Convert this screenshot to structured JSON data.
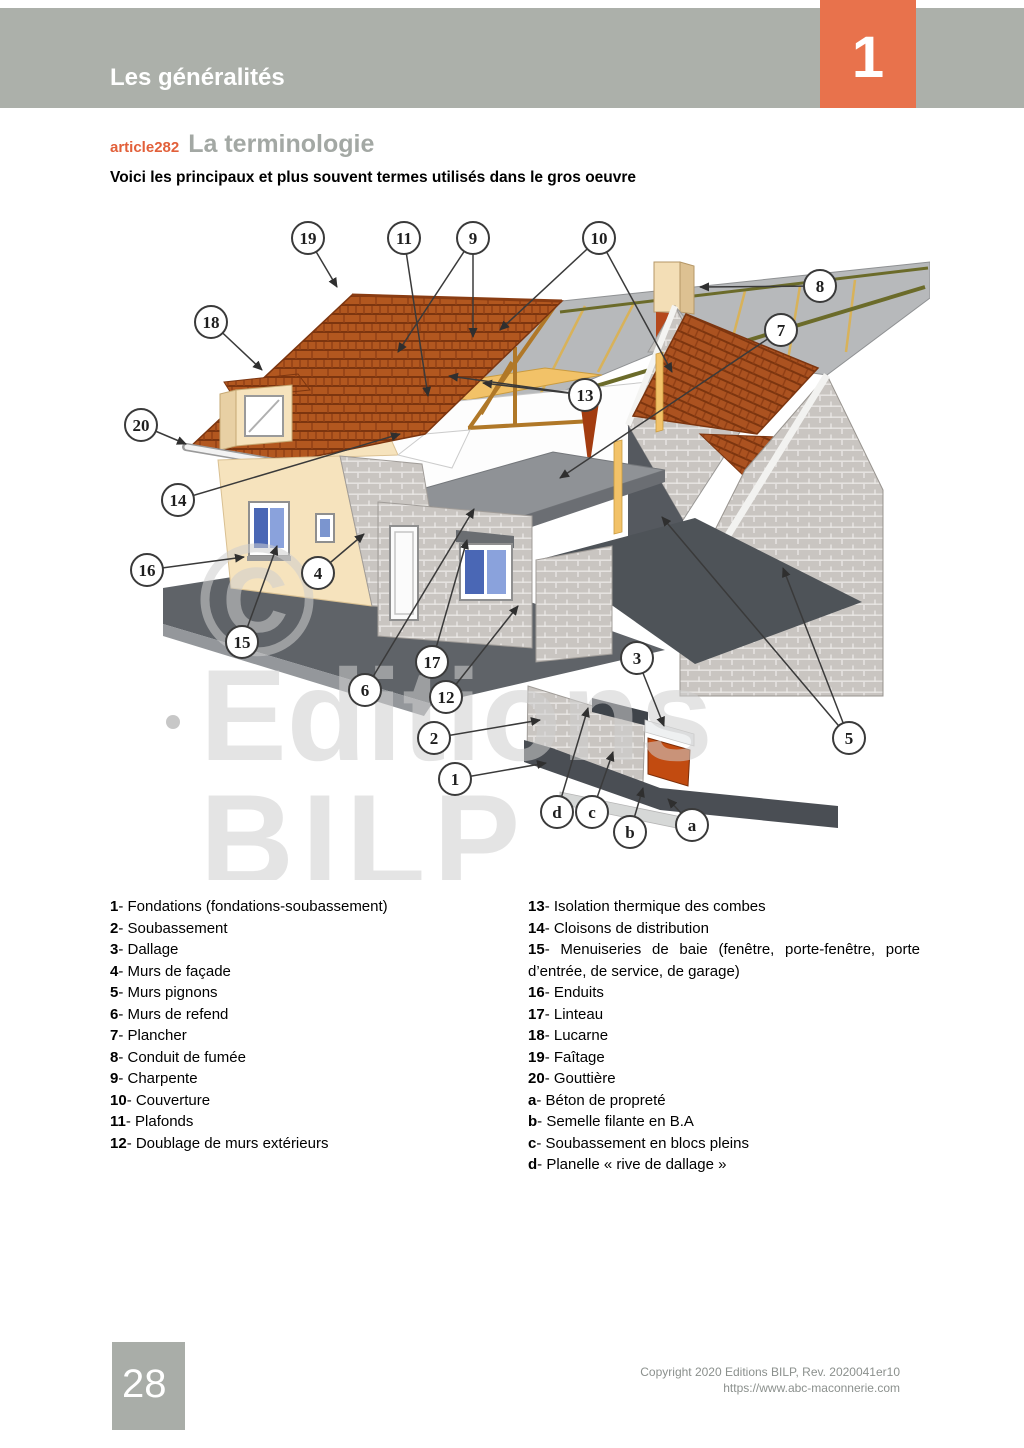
{
  "header": {
    "chapter_title": "Les généralités",
    "chapter_number": "1"
  },
  "article": {
    "id": "article282",
    "title": "La terminologie",
    "intro": "Voici les principaux et plus souvent termes utilisés dans le gros oeuvre"
  },
  "diagram": {
    "watermark": {
      "symbol": "©",
      "line1": "Editions",
      "line2": "BILP"
    },
    "callouts": [
      {
        "label": "19",
        "x": 308,
        "y": 238,
        "targets": [
          [
            337,
            287
          ]
        ]
      },
      {
        "label": "11",
        "x": 404,
        "y": 238,
        "targets": [
          [
            428,
            396
          ]
        ]
      },
      {
        "label": "9",
        "x": 473,
        "y": 238,
        "targets": [
          [
            473,
            337
          ],
          [
            398,
            352
          ]
        ]
      },
      {
        "label": "10",
        "x": 599,
        "y": 238,
        "targets": [
          [
            500,
            330
          ],
          [
            672,
            372
          ]
        ]
      },
      {
        "label": "8",
        "x": 820,
        "y": 286,
        "targets": [
          [
            700,
            287
          ]
        ]
      },
      {
        "label": "7",
        "x": 781,
        "y": 330,
        "targets": [
          [
            560,
            478
          ]
        ]
      },
      {
        "label": "18",
        "x": 211,
        "y": 322,
        "targets": [
          [
            262,
            370
          ]
        ]
      },
      {
        "label": "13",
        "x": 585,
        "y": 395,
        "targets": [
          [
            483,
            383
          ],
          [
            449,
            376
          ]
        ]
      },
      {
        "label": "20",
        "x": 141,
        "y": 425,
        "targets": [
          [
            186,
            444
          ]
        ]
      },
      {
        "label": "14",
        "x": 178,
        "y": 500,
        "targets": [
          [
            400,
            434
          ]
        ]
      },
      {
        "label": "16",
        "x": 147,
        "y": 570,
        "targets": [
          [
            244,
            557
          ]
        ]
      },
      {
        "label": "4",
        "x": 318,
        "y": 573,
        "targets": [
          [
            364,
            534
          ]
        ]
      },
      {
        "label": "15",
        "x": 242,
        "y": 642,
        "targets": [
          [
            277,
            546
          ]
        ]
      },
      {
        "label": "6",
        "x": 365,
        "y": 690,
        "targets": [
          [
            474,
            509
          ]
        ]
      },
      {
        "label": "17",
        "x": 432,
        "y": 662,
        "targets": [
          [
            467,
            540
          ]
        ]
      },
      {
        "label": "12",
        "x": 446,
        "y": 697,
        "targets": [
          [
            518,
            606
          ]
        ]
      },
      {
        "label": "2",
        "x": 434,
        "y": 738,
        "targets": [
          [
            540,
            720
          ]
        ]
      },
      {
        "label": "1",
        "x": 455,
        "y": 779,
        "targets": [
          [
            546,
            763
          ]
        ]
      },
      {
        "label": "3",
        "x": 637,
        "y": 658,
        "targets": [
          [
            664,
            726
          ]
        ]
      },
      {
        "label": "5",
        "x": 849,
        "y": 738,
        "targets": [
          [
            662,
            517
          ],
          [
            783,
            568
          ]
        ]
      },
      {
        "label": "d",
        "x": 557,
        "y": 812,
        "targets": [
          [
            588,
            708
          ]
        ]
      },
      {
        "label": "c",
        "x": 592,
        "y": 812,
        "targets": [
          [
            613,
            752
          ]
        ]
      },
      {
        "label": "b",
        "x": 630,
        "y": 832,
        "targets": [
          [
            643,
            788
          ]
        ]
      },
      {
        "label": "a",
        "x": 692,
        "y": 825,
        "targets": [
          [
            668,
            799
          ]
        ]
      }
    ]
  },
  "legend": {
    "left": [
      {
        "num": "1",
        "text": "Fondations (fondations-soubassement)"
      },
      {
        "num": "2",
        "text": "Soubassement"
      },
      {
        "num": "3",
        "text": "Dallage"
      },
      {
        "num": "4",
        "text": "Murs de façade"
      },
      {
        "num": "5",
        "text": "Murs pignons"
      },
      {
        "num": "6",
        "text": "Murs de refend"
      },
      {
        "num": "7",
        "text": "Plancher"
      },
      {
        "num": "8",
        "text": "Conduit de fumée"
      },
      {
        "num": "9",
        "text": "Charpente"
      },
      {
        "num": "10",
        "text": "Couverture"
      },
      {
        "num": "11",
        "text": "Plafonds"
      },
      {
        "num": "12",
        "text": "Doublage de murs extérieurs"
      }
    ],
    "right": [
      {
        "num": "13",
        "text": "Isolation thermique des combes"
      },
      {
        "num": "14",
        "text": "Cloisons de distribution"
      },
      {
        "num": "15",
        "text": "Menuiseries de baie (fenêtre, porte-fenêtre, porte d’entrée, de service, de garage)"
      },
      {
        "num": "16",
        "text": "Enduits"
      },
      {
        "num": "17",
        "text": "Linteau"
      },
      {
        "num": "18",
        "text": "Lucarne"
      },
      {
        "num": "19",
        "text": "Faîtage"
      },
      {
        "num": "20",
        "text": "Gouttière"
      },
      {
        "num": "a",
        "text": "Béton de propreté"
      },
      {
        "num": "b",
        "text": "Semelle filante en B.A"
      },
      {
        "num": "c",
        "text": "Soubassement en blocs pleins"
      },
      {
        "num": "d",
        "text": "Planelle « rive de dallage »"
      }
    ]
  },
  "footer": {
    "page_number": "28",
    "copyright_line1": "Copyright 2020 Editions BILP, Rev. 2020041er10",
    "copyright_line2": "https://www.abc-maconnerie.com"
  },
  "colors": {
    "header_bar": "#acb0aa",
    "chapter_box_orange": "#e8724c",
    "article_label_orange": "#e2603a",
    "title_gray": "#a3a8a4",
    "roof_tiles": "#b2571f",
    "facade_cream": "#f6e3bd",
    "block_wall": "#c9c5c1",
    "slab_dark": "#54585e",
    "insulation_yellow": "#f2c268",
    "window_blue": "#4a67b5",
    "foundation_orange": "#c24b10",
    "watermark_gray": "#cfcfcf",
    "footer_text": "#8b908d"
  }
}
